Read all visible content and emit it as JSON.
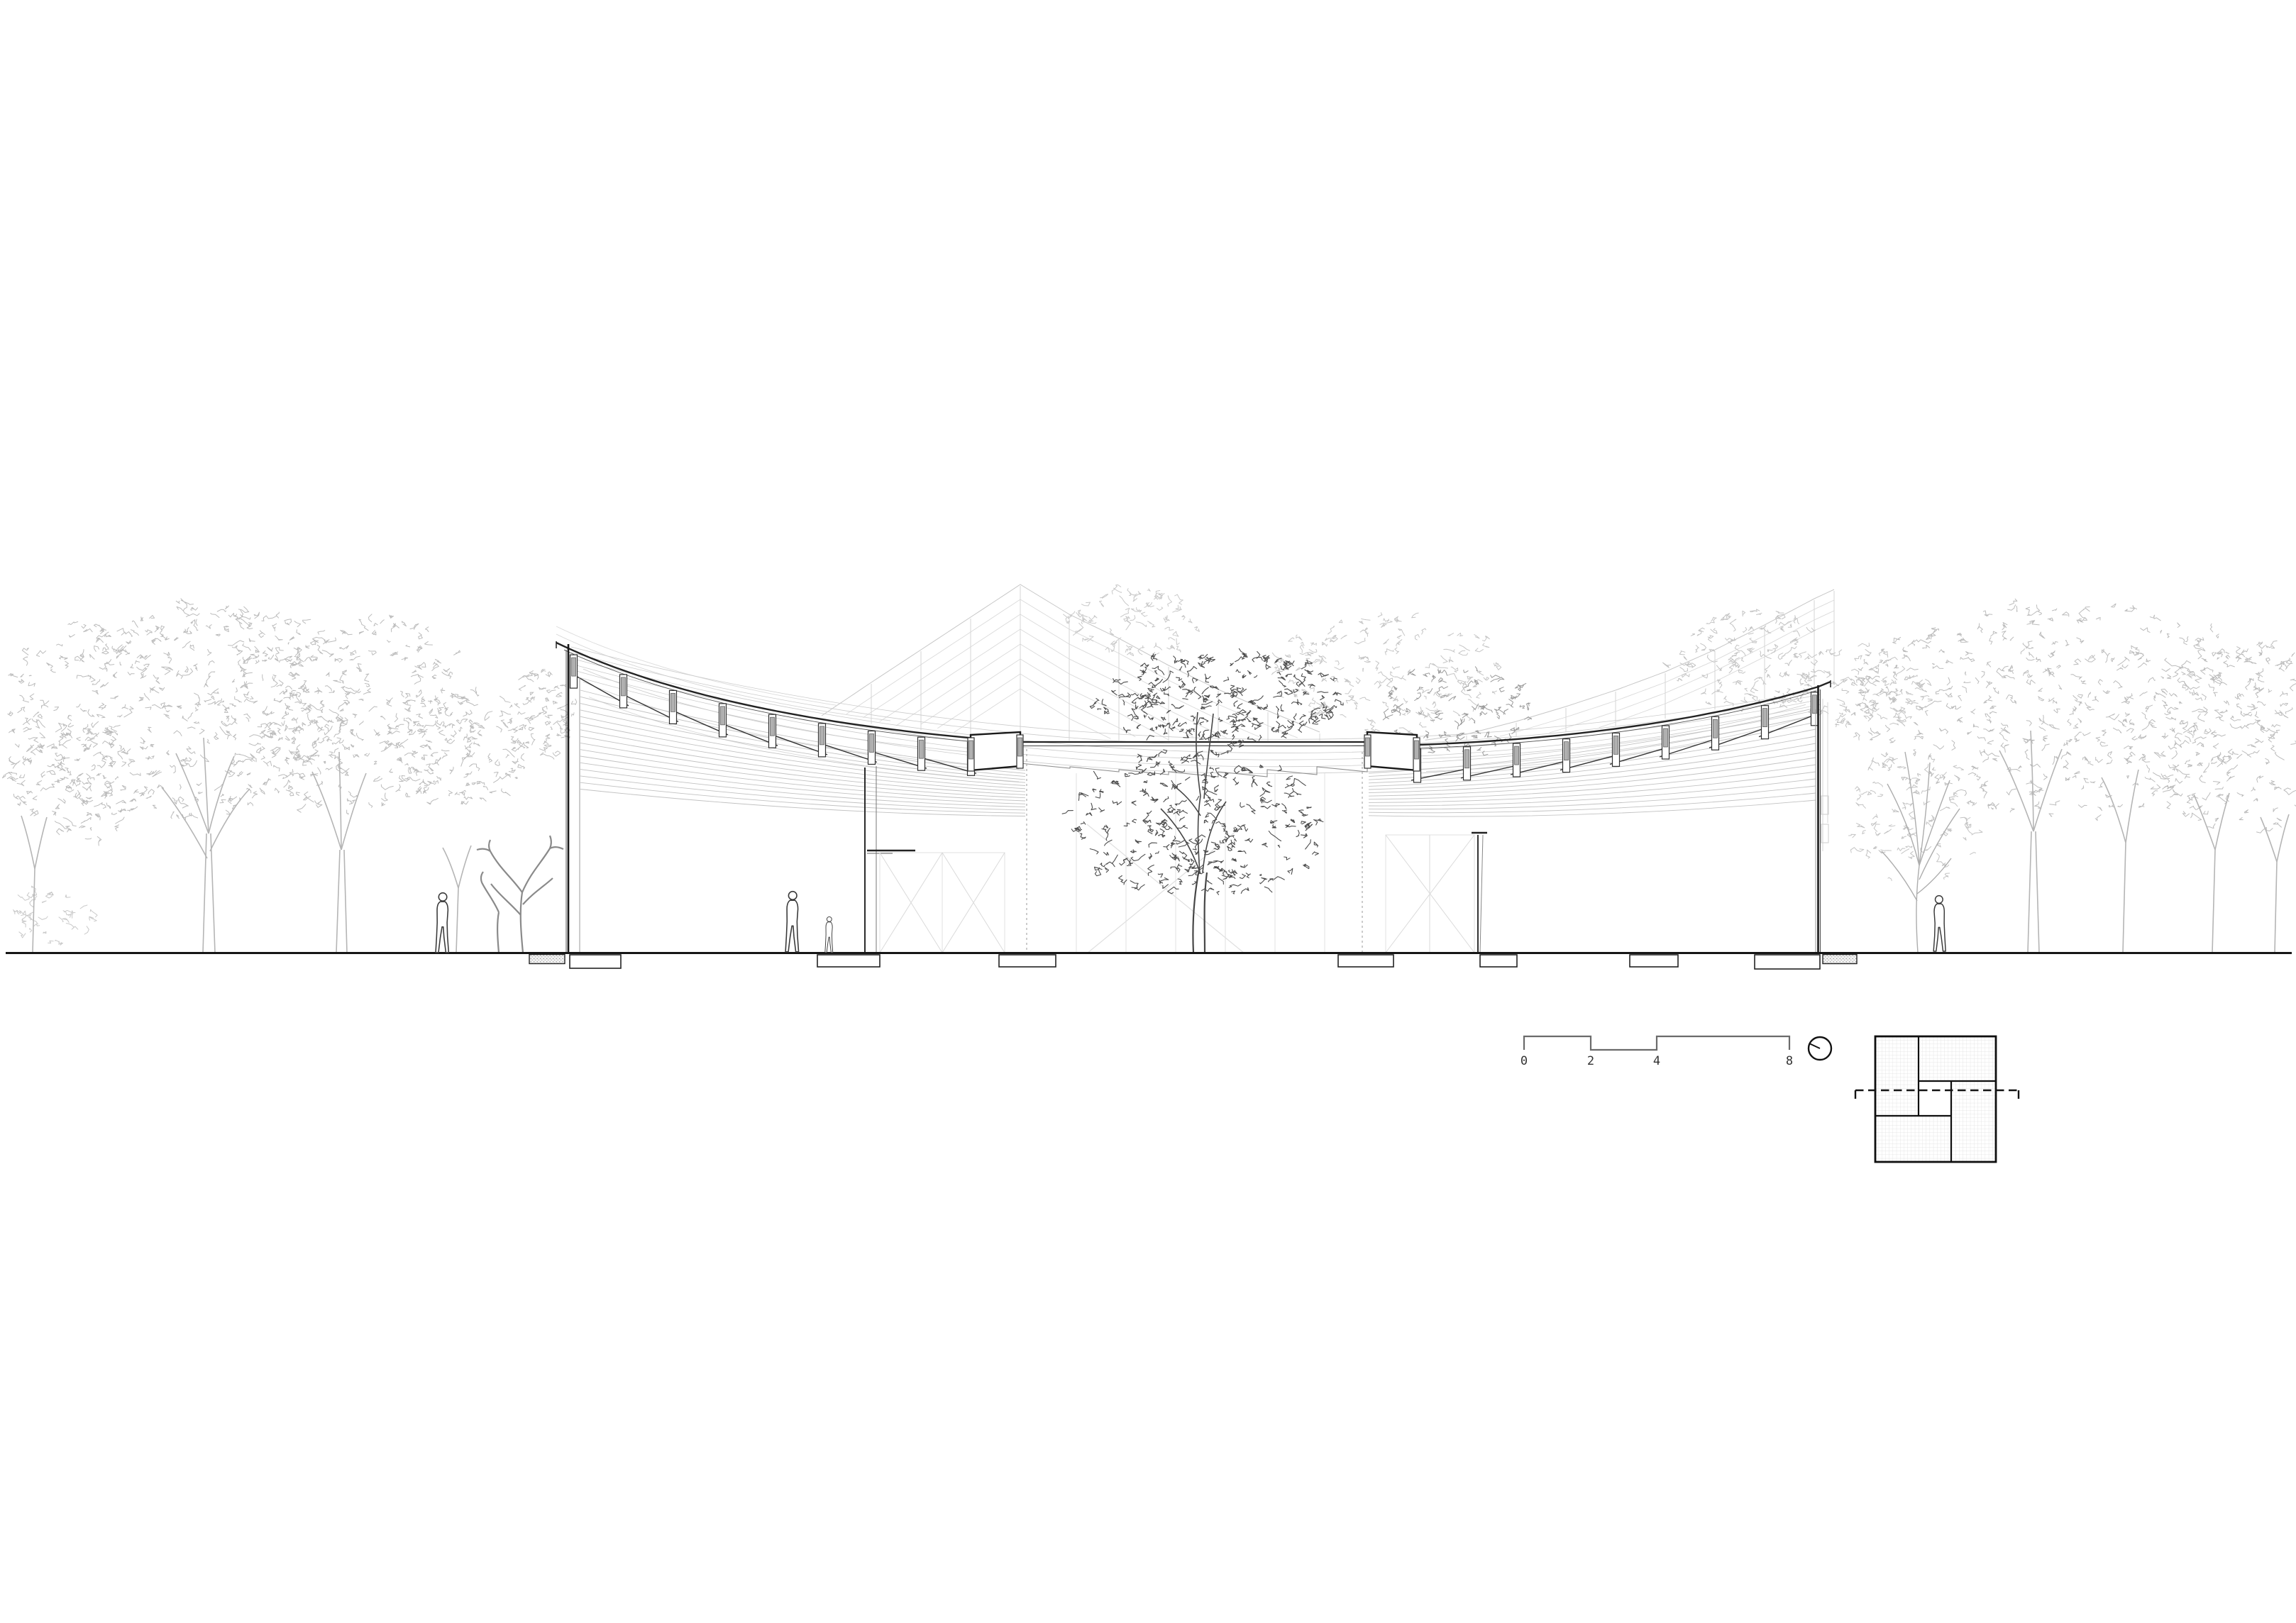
{
  "page": {
    "background": "#ffffff",
    "kind": "architectural-section-elevation"
  },
  "scale_bar": {
    "labels": [
      "0",
      "2",
      "4",
      "8"
    ]
  },
  "icons": {
    "north_indicator": "circle-with-tilted-pointer-icon"
  },
  "key_plan": {
    "hatched_rooms": 4,
    "open_center_court": true,
    "section_line_style": "dashed-with-end-ticks"
  },
  "depicted": {
    "human_figures": 4,
    "courtyard_tree": 1,
    "park_trees": "light line-drawn trees left and right"
  },
  "colors": {
    "ink": "#1a1a1a",
    "cut": "#232323",
    "medium": "#555555",
    "interior_line": "#8f8f8f",
    "mullion_fill": "#b0b0b0",
    "catenary": "#c2c2c2",
    "faint": "#d9d9d9",
    "light_tree": "#bcbcbc",
    "dark_tree": "#4d4d4d",
    "hatch": "#dedede"
  }
}
